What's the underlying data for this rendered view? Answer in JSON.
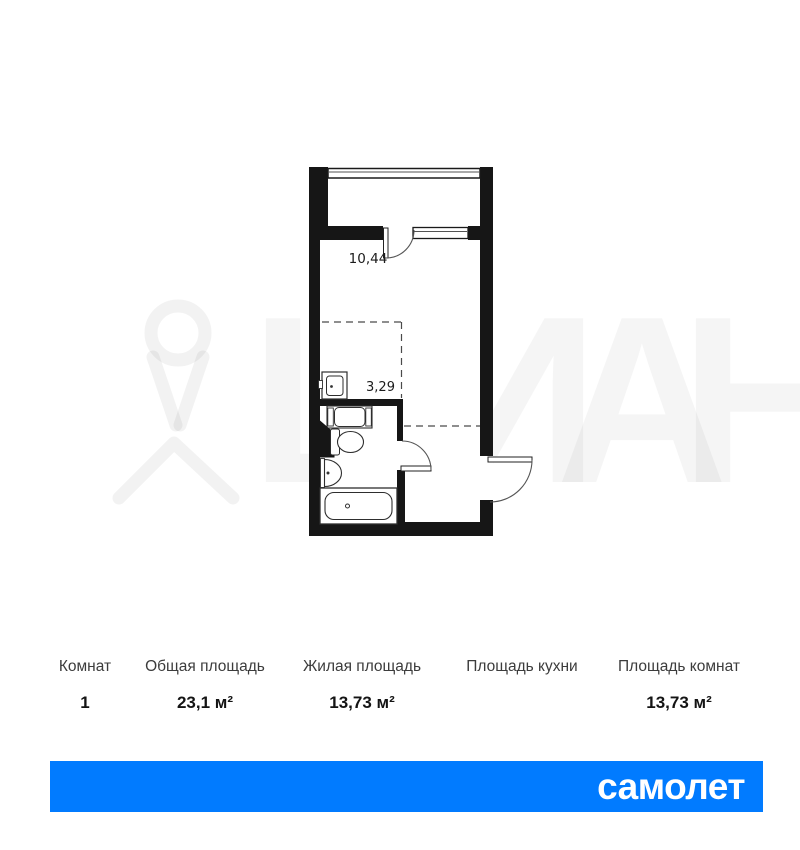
{
  "floorplan": {
    "room_area_label": "10,44",
    "kitchen_area_label": "3,29",
    "wall_color": "#161616",
    "fixtures": [
      "balcony-glazing",
      "window",
      "balcony-door",
      "kitchen-sink",
      "washing-machine",
      "shaft",
      "toilet",
      "washbasin",
      "bathtub",
      "bathroom-door",
      "entrance-door"
    ]
  },
  "table": {
    "columns": [
      {
        "header": "Комнат",
        "value": "1"
      },
      {
        "header": "Общая площадь",
        "value": "23,1 м²"
      },
      {
        "header": "Жилая площадь",
        "value": "13,73 м²"
      },
      {
        "header": "Площадь кухни",
        "value": ""
      },
      {
        "header": "Площадь комнат",
        "value": "13,73 м²"
      }
    ]
  },
  "watermark": {
    "letters": [
      "Ц",
      "И",
      "А",
      "Н"
    ],
    "icon": "cian-pin"
  },
  "banner": {
    "brand": "самолет",
    "color": "#017BFF",
    "text_color": "#FFFFFF"
  },
  "background": "#FFFFFF"
}
